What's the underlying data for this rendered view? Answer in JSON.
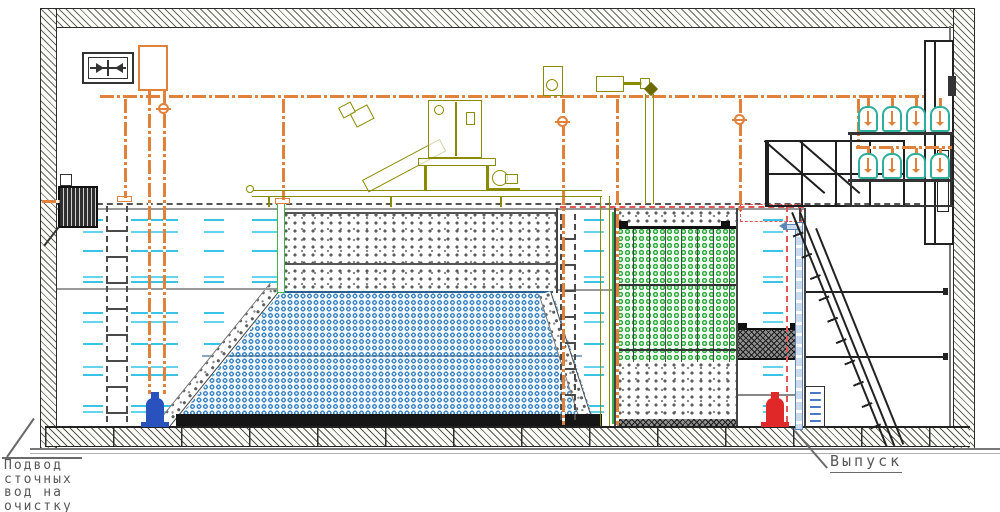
{
  "labels": {
    "inlet": "Подвод\nсточных\nвод на\nочистку",
    "outlet": "Выпуск"
  },
  "colors": {
    "pipe_orange": "#E0813C",
    "equipment_olive": "#8B8B00",
    "blower_teal": "#2FAE9E",
    "water_cyan": "#39C3E6",
    "media_blue": "#3F86C4",
    "media_green": "#35AE45",
    "media_gray_dots": "#5D5D5D",
    "pump_blue": "#2A52BE",
    "pump_red": "#E02828",
    "red_dashed_line": "#E05555",
    "outlet_pipe_blue": "#5B87B8",
    "structure_dark": "#222222",
    "label_gray": "#585858"
  },
  "component_icons": {
    "building_shell": "hatched-wall",
    "ventilation_unit": "fan-box",
    "expansion_tank": "orange-rect",
    "air_main": "orange-dash-dot-pipe",
    "inlet_screen_basket": "barred-box",
    "access_ladder": "dashed-ladder",
    "submersible_pump_inlet": "blue-pump",
    "discharge_pump": "red-pump",
    "floating_media": "gray-dot-fill",
    "submerged_media": "blue-ring-fill",
    "bio_media": "green-ring-fill",
    "aeration_base": "black-strip",
    "sludge_block": "crosshatch-block",
    "blower_unit": "teal-bell",
    "staircase": "diagonal-stairs",
    "service_platform": "railing-grid",
    "screen_equipment": "olive-outline-machines",
    "valve": "orange-circle-valve"
  }
}
